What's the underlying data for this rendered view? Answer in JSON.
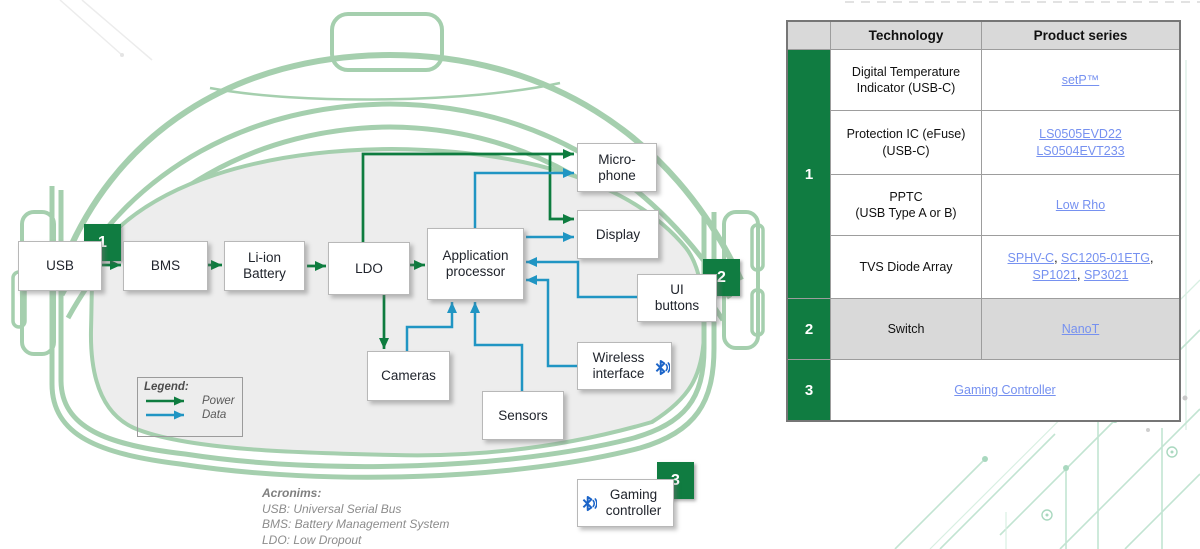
{
  "colors": {
    "accent_green": "#107c41",
    "power_arrow_green": "#0e7c3f",
    "data_arrow_blue": "#2095c3",
    "headset_outline_green": "#a5cfae",
    "faceplate_gray": "#ededed",
    "table_header_gray": "#d9d9d9",
    "link_blue": "#7691f0",
    "bluetooth_blue": "#1b64c8"
  },
  "diagram": {
    "boxes": {
      "usb": "USB",
      "bms": "BMS",
      "liion": "Li-ion Battery",
      "ldo": "LDO",
      "app": "Application processor",
      "mic": "Micro-phone",
      "display": "Display",
      "ui": "UI buttons",
      "wireless": "Wireless interface",
      "sensors": "Sensors",
      "cameras": "Cameras",
      "gaming": "Gaming controller"
    },
    "badges": {
      "b1": "1",
      "b2": "2",
      "b3": "3"
    },
    "legend": {
      "title": "Legend:",
      "power": "Power",
      "data": "Data"
    },
    "acronyms": {
      "title": "Acronims:",
      "line1": "USB: Universal Serial Bus",
      "line2": "BMS: Battery Management System",
      "line3": "LDO: Low Dropout"
    }
  },
  "table": {
    "header": {
      "technology": "Technology",
      "product_series": "Product series"
    },
    "groups": [
      {
        "num": "1"
      },
      {
        "num": "2"
      },
      {
        "num": "3"
      }
    ],
    "rows": [
      {
        "tech": [
          {
            "t": "text",
            "v": "Digital Temperature"
          },
          {
            "t": "br"
          },
          {
            "t": "text",
            "v": "Indicator (USB-C)"
          }
        ],
        "products": [
          {
            "t": "link",
            "v": "setP™"
          }
        ]
      },
      {
        "tech": [
          {
            "t": "text",
            "v": "Protection IC (eFuse)"
          },
          {
            "t": "br"
          },
          {
            "t": "text",
            "v": "(USB-C)"
          }
        ],
        "products": [
          {
            "t": "link",
            "v": "LS0505EVD22"
          },
          {
            "t": "br"
          },
          {
            "t": "link",
            "v": "LS0504EVT233"
          }
        ]
      },
      {
        "tech": [
          {
            "t": "text",
            "v": "PPTC"
          },
          {
            "t": "br"
          },
          {
            "t": "text",
            "v": "(USB Type A or B)"
          }
        ],
        "products": [
          {
            "t": "link",
            "v": "Low Rho"
          }
        ]
      },
      {
        "tech": [
          {
            "t": "text",
            "v": "TVS Diode Array"
          }
        ],
        "products": [
          {
            "t": "link",
            "v": "SPHV-C"
          },
          {
            "t": "text",
            "v": ", "
          },
          {
            "t": "link",
            "v": "SC1205-01ETG"
          },
          {
            "t": "text",
            "v": ", "
          },
          {
            "t": "link",
            "v": "SP1021"
          },
          {
            "t": "text",
            "v": ", "
          },
          {
            "t": "link",
            "v": "SP3021"
          }
        ]
      },
      {
        "tech": [
          {
            "t": "text",
            "v": "Switch"
          }
        ],
        "products": [
          {
            "t": "link",
            "v": "NanoT"
          }
        ]
      },
      {
        "products": [
          {
            "t": "link",
            "v": "Gaming Controller"
          }
        ]
      }
    ]
  }
}
